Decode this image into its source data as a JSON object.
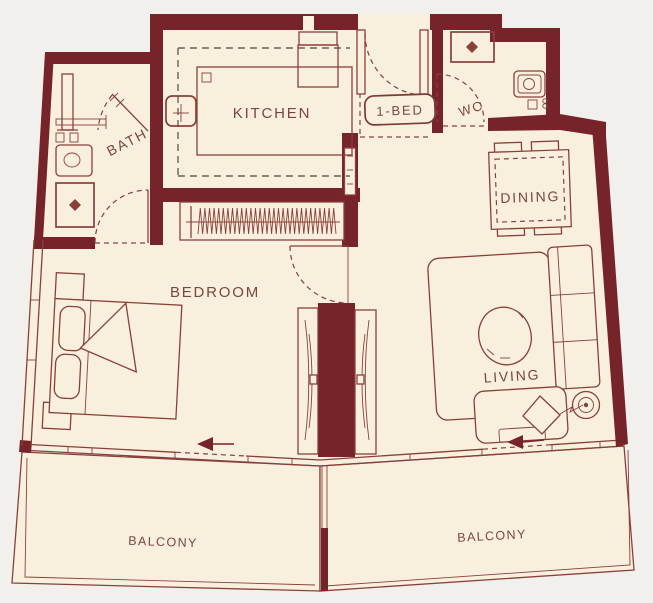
{
  "palette": {
    "background": "#f2f0ec",
    "floor": "#f8f0dd",
    "wall": "#76242a",
    "furniture_line": "#8a4039",
    "label_text": "#7c463c"
  },
  "rooms": {
    "kitchen": {
      "label": "KITCHEN"
    },
    "bath": {
      "label": "BATH"
    },
    "wc": {
      "label": "WC"
    },
    "dining": {
      "label": "DINING"
    },
    "bedroom": {
      "label": "BEDROOM"
    },
    "living": {
      "label": "LIVING"
    },
    "balcony_left": {
      "label": "BALCONY"
    },
    "balcony_right": {
      "label": "BALCONY"
    }
  },
  "unit_badge": {
    "label": "1-BED"
  }
}
